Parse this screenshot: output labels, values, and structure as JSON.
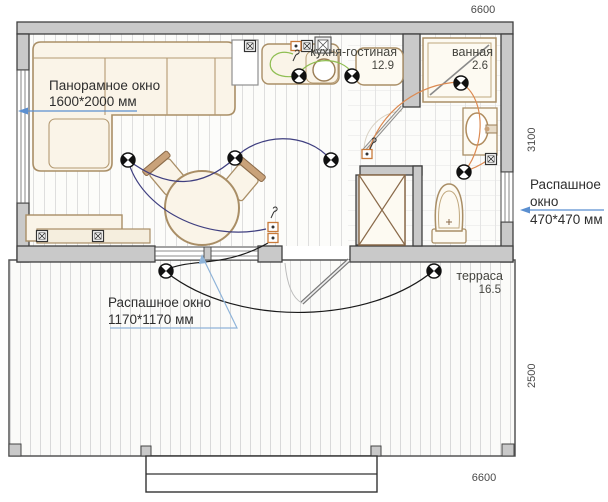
{
  "plan_title": "floor-plan",
  "rooms": {
    "kitchen_living": {
      "name": "кухня-гостиная",
      "area": "12.9"
    },
    "bathroom": {
      "name": "ванная",
      "area": "2.6"
    },
    "terrace": {
      "name": "терраса",
      "area": "16.5"
    }
  },
  "dimensions": {
    "top_mm": "6600",
    "right_upper_mm": "3100",
    "right_lower_mm": "2500",
    "bottom_mm": "6600"
  },
  "annotations": {
    "panoramic_window": {
      "title": "Панорамное окно",
      "size": "1600*2000 мм"
    },
    "casement_window_small": {
      "title_line1": "Распашное",
      "title_line2": "окно",
      "size": "470*470 мм"
    },
    "casement_window_large": {
      "title": "Распашное окно",
      "size": "1170*1170 мм"
    }
  },
  "icons": {
    "ceiling_light": "circle-with-quartered-black-sectors",
    "power_outlet": "square-with-x",
    "socket": "orange-square-with-dot",
    "switch": "hook-glyph",
    "vent": "square-with-grid"
  },
  "colors": {
    "wall_fill": "#c9c9c9",
    "wall_stroke": "#3f3f3f",
    "furniture_fill": "#faf4e8",
    "furniture_stroke": "#a98e66",
    "wire_living": "#3f3f80",
    "wire_terrace": "#1a1a1a",
    "wire_kitchen": "#8fbe52",
    "wire_bathroom": "#dc8a52",
    "annotation_arrow": "#5b8fd0"
  }
}
